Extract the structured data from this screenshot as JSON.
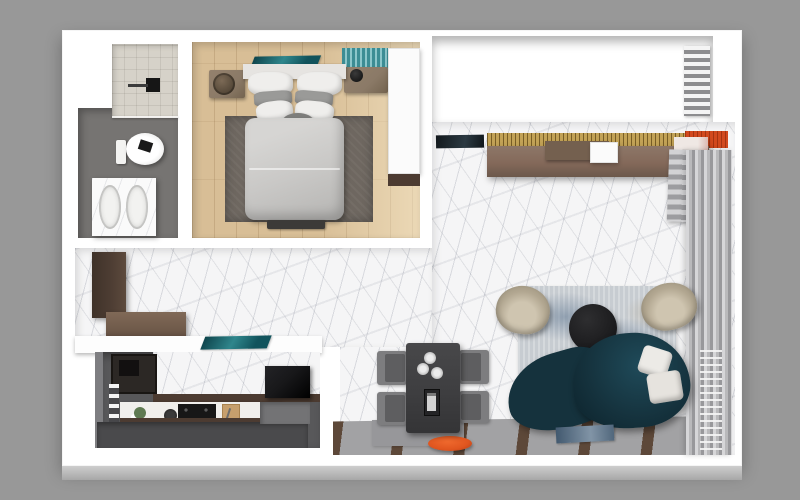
{
  "scene": {
    "type": "3d-floor-plan-render",
    "view": "top-down",
    "description": "Photorealistic top-down 3D render of a studio apartment floor plan on a gray background"
  },
  "palette": {
    "bg": "#989898",
    "wall": "#ffffff",
    "slabFront": "#c7c7c7",
    "marbleBase": "#f5f5f6",
    "woodFloor": "#d8be96",
    "rugBedroom": "#6e6760",
    "duvet": "#c9c8c6",
    "pillowWhite": "#efeeec",
    "pillowGray": "#9a9a98",
    "nightstand": "#8b7a67",
    "tealArt": "#1d6a72",
    "tealBlind": "#4b969c",
    "bathFloor": "#767472",
    "showerTile": "#d6d2c9",
    "balconyFloor": "#6b6b6e",
    "goldPanel": "#c2a256",
    "orangeAccent": "#d2491e",
    "consoleWood": "#84695a",
    "curtain": "#b9b9bb",
    "sofaTeal": "#15323d",
    "armchair": "#b2a791",
    "coffeeTable": "#1a1a1c",
    "rugLivingBase": "#c7ccd1",
    "rugLivingBlue": "#7e94a9",
    "diningTable": "#3e3e40",
    "chairGray": "#7d7d7f",
    "stripeFloorBase": "#a2a2a4",
    "stripeBrown": "#5d4839",
    "kitchenFloor": "#58585a",
    "kitchenIsland": "#4a4a4c",
    "cabinetBrown": "#4c3b31",
    "cabinetDark": "#2c2825",
    "counterWhite": "#f0efec",
    "fridgeBlack": "#18181a",
    "entryCabinet": "#4d3d33",
    "benchWood": "#6f5a4a",
    "orangeStool": "#e0551f",
    "matGray": "#97979a"
  },
  "rooms": [
    {
      "id": "bathroom",
      "label": "Bathroom",
      "furniture": [
        "walk-in shower",
        "wall-hung toilet",
        "double-sink vanity"
      ]
    },
    {
      "id": "bedroom",
      "label": "Bedroom",
      "furniture": [
        "double bed",
        "left nightstand with basket",
        "right nightstand with lamp",
        "dark rug",
        "teal artwork",
        "teal striped blind",
        "white wardrobe",
        "foot bench"
      ]
    },
    {
      "id": "balcony",
      "label": "Balcony",
      "furniture": [
        "tiled floor",
        "white louver grate"
      ]
    },
    {
      "id": "hallway",
      "label": "Entry Hall",
      "furniture": [
        "tall brown cabinet",
        "wood bench",
        "teal floor mat",
        "white half wall"
      ]
    },
    {
      "id": "kitchen",
      "label": "Kitchen",
      "furniture": [
        "dark upper cabinets",
        "bottle shelf",
        "white counter with gas hob",
        "cutting board",
        "plant",
        "dark island bar",
        "black fridge"
      ]
    },
    {
      "id": "dining",
      "label": "Dining Area",
      "furniture": [
        "dark rectangular table",
        "four gray chairs",
        "three plates",
        "serving tray",
        "orange oval stool",
        "gray floor mat"
      ]
    },
    {
      "id": "living",
      "label": "Living Room",
      "furniture": [
        "tv panel",
        "gold slat panel",
        "orange wall panel",
        "long wood media console",
        "storage boxes",
        "gray curtains",
        "radiator",
        "blue distressed rug",
        "two beige tub armchairs",
        "round black coffee table",
        "curved teal sofa",
        "two white pillows",
        "blue magazine",
        "striped wood runner floor"
      ]
    }
  ]
}
